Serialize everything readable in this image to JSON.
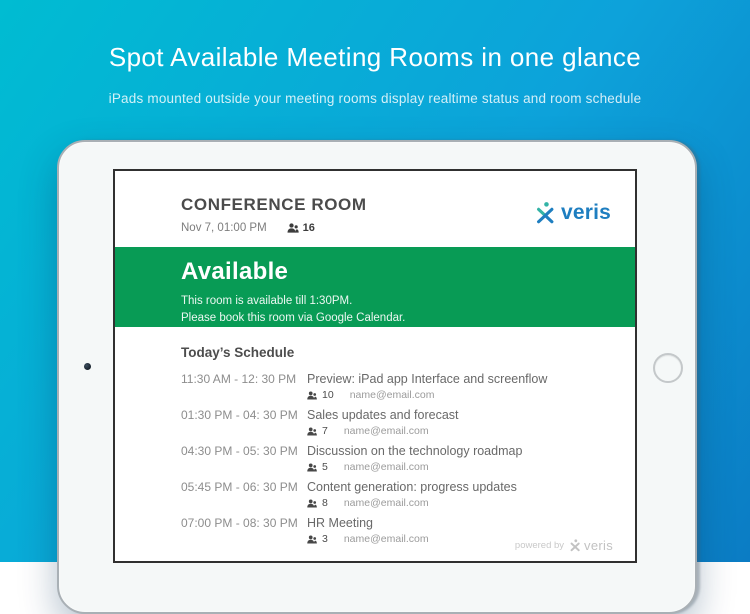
{
  "hero": {
    "title": "Spot Available Meeting Rooms in one glance",
    "subtitle": "iPads mounted outside your meeting rooms display realtime status and room schedule"
  },
  "screen": {
    "header": {
      "room_name": "CONFERENCE ROOM",
      "datetime": "Nov 7, 01:00 PM",
      "capacity": "16",
      "logo_text": "veris"
    },
    "status": {
      "state": "Available",
      "line1": "This room is available till 1:30PM.",
      "line2": "Please book this room via Google Calendar.",
      "color": "#089b55"
    },
    "schedule": {
      "heading": "Today’s Schedule",
      "events": [
        {
          "time": "11:30 AM - 12: 30 PM",
          "title": "Preview: iPad app Interface and screenflow",
          "attendees": "10",
          "organizer": "name@email.com"
        },
        {
          "time": "01:30 PM - 04: 30 PM",
          "title": "Sales updates and forecast",
          "attendees": "7",
          "organizer": "name@email.com"
        },
        {
          "time": "04:30 PM - 05: 30 PM",
          "title": "Discussion on the technology roadmap",
          "attendees": "5",
          "organizer": "name@email.com"
        },
        {
          "time": "05:45 PM - 06: 30 PM",
          "title": "Content generation: progress updates",
          "attendees": "8",
          "organizer": "name@email.com"
        },
        {
          "time": "07:00 PM - 08: 30 PM",
          "title": "HR Meeting",
          "attendees": "3",
          "organizer": "name@email.com"
        }
      ]
    },
    "footer": {
      "powered_by": "powered by",
      "logo_text": "veris"
    }
  },
  "colors": {
    "background_gradient_start": "#00bcd2",
    "background_gradient_end": "#0b7cc4",
    "status_available_green": "#089b55",
    "brand_blue": "#1e7ec0",
    "brand_teal": "#33b3a6"
  }
}
